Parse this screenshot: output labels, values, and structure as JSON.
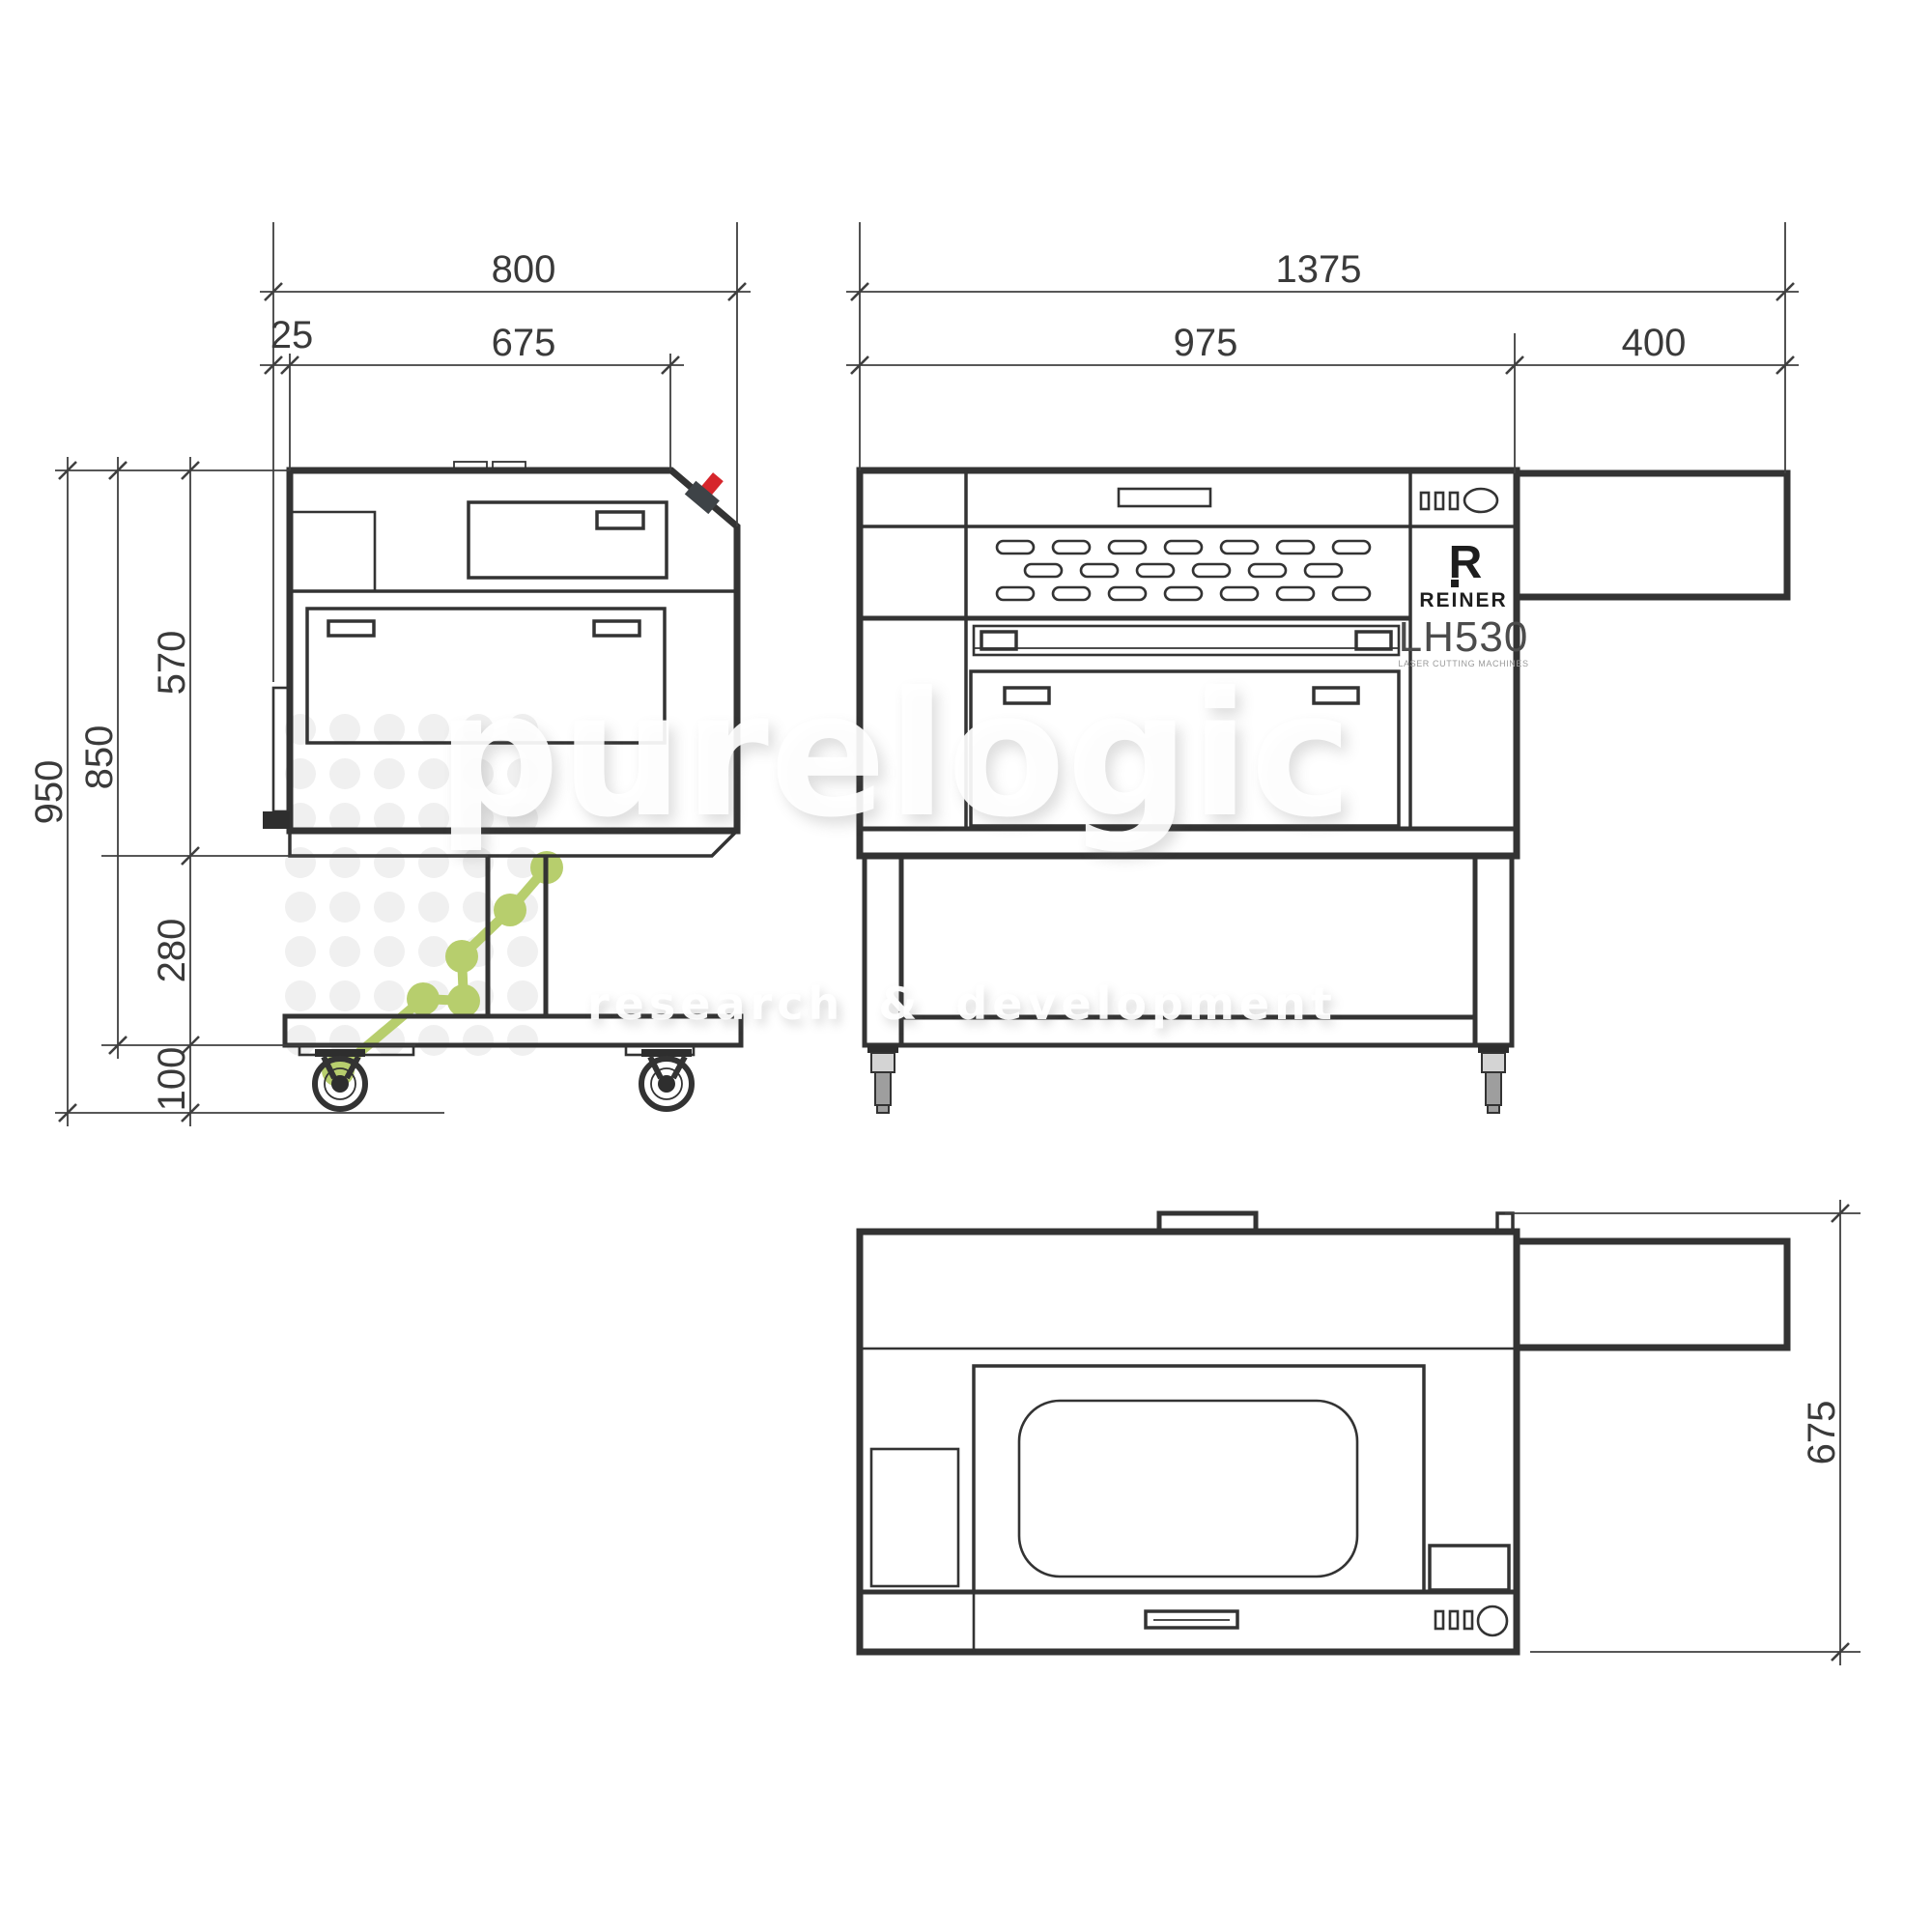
{
  "brand": {
    "initial": "R",
    "name": "REINER",
    "model": "LH530",
    "model_subtitle": "LASER CUTTING MACHINES"
  },
  "dimensions": {
    "side": {
      "total_depth": "800",
      "rear_offset": "25",
      "upper_depth": "675",
      "body_height": "570",
      "body_with_stand_height": "850",
      "total_height": "950",
      "stand_height": "280",
      "caster_height": "100"
    },
    "front": {
      "total_width": "1375",
      "cabinet_width": "975",
      "extension_width": "400"
    },
    "top": {
      "depth": "675"
    }
  },
  "watermark": {
    "logo": "purelogic",
    "tagline": "research & development",
    "accent_color": "#b7ce6d",
    "dot_color": "#f0f0f0"
  },
  "colors": {
    "line": "#333333",
    "dimension_text": "#3a3a3a",
    "estop_red": "#d6252b",
    "estop_base": "#3e4347",
    "caster_gray": "#9e9e9e"
  }
}
